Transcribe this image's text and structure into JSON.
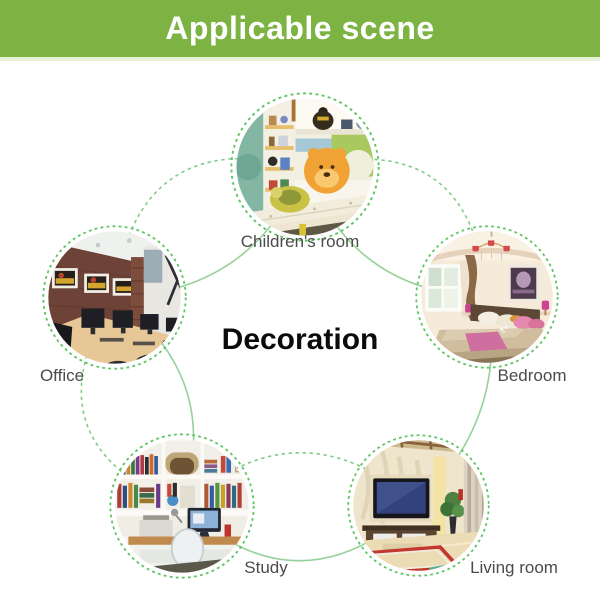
{
  "banner": {
    "title": "Applicable scene"
  },
  "diagram": {
    "center_label": "Decoration",
    "nodes": [
      {
        "id": "children-room",
        "label": "Children's room",
        "photo": "children-room-photo"
      },
      {
        "id": "bedroom",
        "label": "Bedroom",
        "photo": "bedroom-photo"
      },
      {
        "id": "living-room",
        "label": "Living room",
        "photo": "living-room-photo"
      },
      {
        "id": "study",
        "label": "Study",
        "photo": "study-photo"
      },
      {
        "id": "office",
        "label": "Office",
        "photo": "office-photo"
      }
    ]
  },
  "colors": {
    "banner_green": "#7cb342",
    "ring_green": "#5ec562",
    "connector_green": "#97d29a",
    "label_gray": "#4b4b4b",
    "center_title_black": "#0b0b0b"
  }
}
